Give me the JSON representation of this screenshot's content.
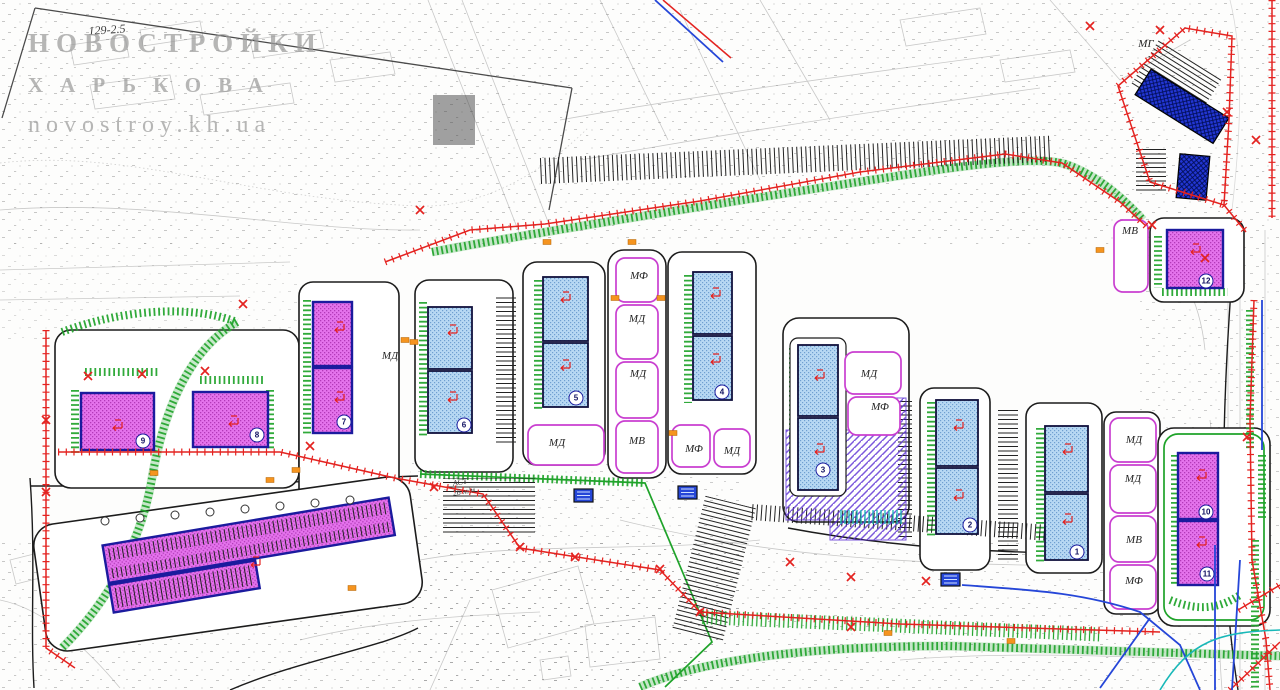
{
  "watermark": {
    "line1": "НОВОСТРОЙКИ",
    "line2": "ХАРЬКОВА",
    "line3": "novostroy.kh.ua"
  },
  "annotations": [
    {
      "text": "129-2.5",
      "x": 88,
      "y": 24,
      "rot": -4,
      "size": 12
    },
    {
      "text": "АСТ",
      "x": 452,
      "y": 479,
      "rot": -10,
      "size": 8
    },
    {
      "text": "26 м/м",
      "x": 452,
      "y": 489,
      "rot": -10,
      "size": 8
    }
  ],
  "zone_labels": [
    {
      "text": "МД",
      "x": 390,
      "y": 356
    },
    {
      "text": "МФ",
      "x": 639,
      "y": 276
    },
    {
      "text": "МД",
      "x": 637,
      "y": 319
    },
    {
      "text": "МД",
      "x": 638,
      "y": 374
    },
    {
      "text": "МВ",
      "x": 637,
      "y": 441
    },
    {
      "text": "МД",
      "x": 557,
      "y": 443
    },
    {
      "text": "МФ",
      "x": 694,
      "y": 449
    },
    {
      "text": "МД",
      "x": 732,
      "y": 451
    },
    {
      "text": "МД",
      "x": 869,
      "y": 374
    },
    {
      "text": "МФ",
      "x": 880,
      "y": 407
    },
    {
      "text": "МД",
      "x": 1134,
      "y": 440
    },
    {
      "text": "МД",
      "x": 1133,
      "y": 479
    },
    {
      "text": "МВ",
      "x": 1134,
      "y": 540
    },
    {
      "text": "МФ",
      "x": 1134,
      "y": 581
    },
    {
      "text": "МВ",
      "x": 1130,
      "y": 231
    },
    {
      "text": "МГ",
      "x": 1146,
      "y": 44
    }
  ],
  "building_numbers": [
    {
      "n": "1",
      "x": 1077,
      "y": 552
    },
    {
      "n": "2",
      "x": 970,
      "y": 525
    },
    {
      "n": "3",
      "x": 823,
      "y": 470
    },
    {
      "n": "4",
      "x": 722,
      "y": 392
    },
    {
      "n": "5",
      "x": 576,
      "y": 398
    },
    {
      "n": "6",
      "x": 464,
      "y": 425
    },
    {
      "n": "7",
      "x": 344,
      "y": 422
    },
    {
      "n": "8",
      "x": 257,
      "y": 435
    },
    {
      "n": "9",
      "x": 143,
      "y": 441
    },
    {
      "n": "10",
      "x": 1206,
      "y": 512
    },
    {
      "n": "11",
      "x": 1207,
      "y": 574
    },
    {
      "n": "12",
      "x": 1206,
      "y": 281
    }
  ],
  "marks": {
    "red_x": [
      [
        88,
        376
      ],
      [
        142,
        374
      ],
      [
        205,
        371
      ],
      [
        243,
        304
      ],
      [
        46,
        420
      ],
      [
        46,
        492
      ],
      [
        310,
        446
      ],
      [
        434,
        487
      ],
      [
        520,
        547
      ],
      [
        575,
        557
      ],
      [
        660,
        569
      ],
      [
        790,
        562
      ],
      [
        851,
        577
      ],
      [
        926,
        581
      ],
      [
        700,
        612
      ],
      [
        851,
        627
      ],
      [
        1160,
        30
      ],
      [
        1227,
        112
      ],
      [
        1152,
        225
      ],
      [
        1256,
        140
      ],
      [
        1247,
        437
      ],
      [
        1205,
        258
      ],
      [
        420,
        210
      ],
      [
        1090,
        26
      ]
    ],
    "orange": [
      [
        154,
        473
      ],
      [
        270,
        480
      ],
      [
        405,
        340
      ],
      [
        414,
        342
      ],
      [
        547,
        242
      ],
      [
        632,
        242
      ],
      [
        615,
        298
      ],
      [
        661,
        298
      ],
      [
        673,
        433
      ],
      [
        888,
        633
      ],
      [
        1011,
        641
      ],
      [
        352,
        588
      ],
      [
        296,
        470
      ],
      [
        1100,
        250
      ]
    ],
    "transformers": [
      [
        678,
        486
      ],
      [
        574,
        489
      ],
      [
        941,
        573
      ]
    ],
    "entrance_arrows": [
      [
        447,
        333
      ],
      [
        447,
        400
      ],
      [
        560,
        300
      ],
      [
        560,
        368
      ],
      [
        710,
        296
      ],
      [
        710,
        362
      ],
      [
        814,
        378
      ],
      [
        814,
        452
      ],
      [
        953,
        428
      ],
      [
        953,
        498
      ],
      [
        1062,
        452
      ],
      [
        1062,
        522
      ],
      [
        334,
        330
      ],
      [
        334,
        400
      ],
      [
        112,
        428
      ],
      [
        228,
        424
      ],
      [
        1196,
        478
      ],
      [
        1196,
        545
      ],
      [
        1190,
        252
      ],
      [
        250,
        565
      ]
    ]
  },
  "colors": {
    "magenta": "#e473ec",
    "magenta_dark": "#b23ab8",
    "blue": "#b7d8f3",
    "blue_dark": "#6f9fd0",
    "navy": "#1b1b9e",
    "royal": "#2236d4",
    "red": "#e42320",
    "green": "#1fa32a",
    "violet": "#c93fd0",
    "orange": "#f5941f",
    "teal": "#18b8b8",
    "road": "#1c1c1c",
    "topo": "#8a8a8a",
    "watermark": "#9b9b9b",
    "blue_line": "#2546d8"
  }
}
